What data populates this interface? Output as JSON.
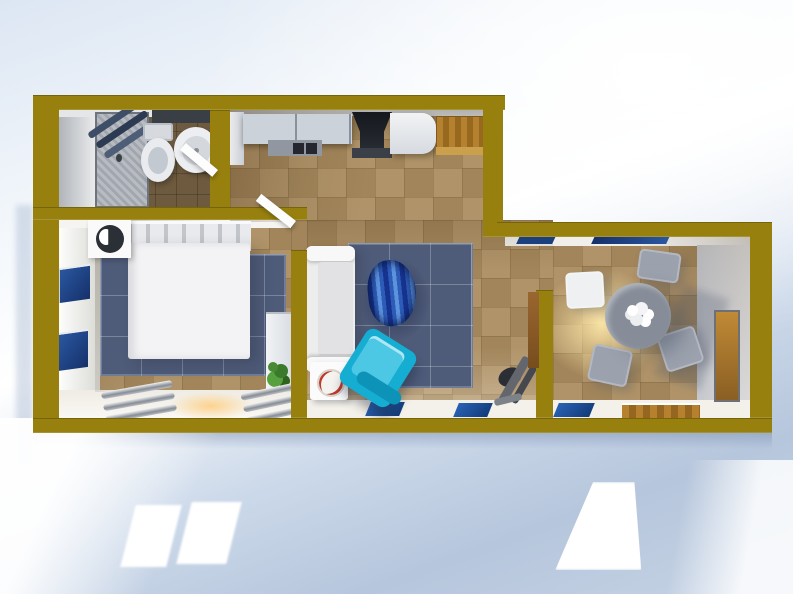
{
  "scene": {
    "title": "apartment-3d-floorplan-top-down-render",
    "style": "3d rendered floor plan, top-down view, no text labels",
    "colors": {
      "wall_olive": "#97800e",
      "floor_tan": "#ab8c5f",
      "bathroom_floor_brown": "#6e5a3e",
      "carpet_slate_blue": "#4e5b79",
      "armchair_cyan": "#15aed2",
      "pouf_stripe_blue_dark": "#16338f",
      "pouf_stripe_blue_light": "#5d93dd",
      "window_navy": "#1c3f7d",
      "wood_amber": "#b5812f",
      "warm_light_glow": "#ffe9b8",
      "background_blue": "#b7c7dd",
      "background_white": "#ffffff",
      "furniture_white": "#f3f3f5",
      "dining_gray": "#868d99"
    },
    "rooms": [
      {
        "name": "bathroom",
        "furniture": [
          "shower-cabin",
          "toilet",
          "sink",
          "dark-shelf",
          "open-door"
        ]
      },
      {
        "name": "kitchen",
        "furniture": [
          "tall-cabinet",
          "upper-cabinets",
          "counter-with-hob",
          "range-hood",
          "fridge",
          "wood-cabinet"
        ]
      },
      {
        "name": "bedroom",
        "furniture": [
          "double-bed",
          "headboard",
          "nightstand-with-lamp",
          "blue-carpet",
          "wardrobe",
          "plant",
          "radiator",
          "radiator",
          "wall-windows",
          "open-door"
        ]
      },
      {
        "name": "living-room",
        "furniture": [
          "white-sofa",
          "side-table-with-plate",
          "blue-rug",
          "striped-pouf",
          "cyan-armchair",
          "hand-truck",
          "floor-mats"
        ]
      },
      {
        "name": "dining-room",
        "furniture": [
          "round-table",
          "flower-centerpiece",
          "chair",
          "chair",
          "chair",
          "chair",
          "ceiling-light-glow",
          "entry-door",
          "balcony-threshold"
        ]
      }
    ]
  }
}
